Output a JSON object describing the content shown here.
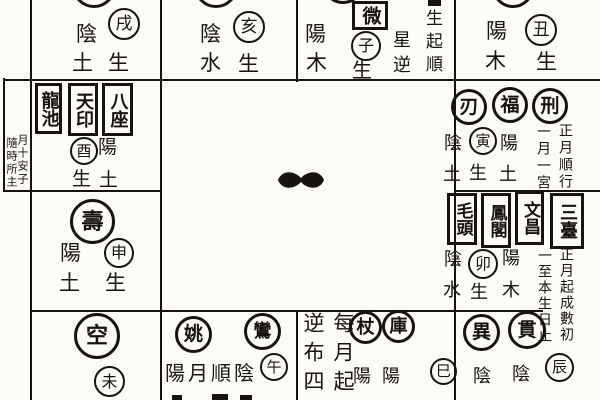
{
  "chart": {
    "ink_color": "#17130e",
    "paper_color": "#fcfbf7",
    "center_mark": "ink-blob",
    "palaces": {
      "xu": {
        "branch": "戌",
        "polarity": "陰",
        "element": "土",
        "sheng": "生"
      },
      "hai": {
        "branch": "亥",
        "polarity": "陰",
        "element": "水",
        "sheng": "生"
      },
      "zi": {
        "branch": "子",
        "polarity": "陽",
        "element": "木",
        "sheng": "生",
        "boxed_star": "微",
        "inner_note": "星逆",
        "rule_note": "生起順"
      },
      "chou": {
        "branch": "丑",
        "polarity": "陽",
        "element": "木",
        "sheng": "生"
      },
      "you": {
        "branch": "酉",
        "polarity": "陽",
        "element": "土",
        "sheng": "生",
        "boxed_stars": [
          "龍池",
          "天印",
          "八座"
        ],
        "margin_note_outer": "隨時所主",
        "margin_note_inner": "月十安子"
      },
      "yin": {
        "branch": "寅",
        "circle_stars": [
          "刃",
          "福",
          "刑"
        ],
        "polarity_left": "陰",
        "element_left": "土",
        "sheng": "生",
        "polarity_right": "陽",
        "element_right": "土",
        "rule_note_inner": "一月一宮",
        "rule_note_outer": "正月順行"
      },
      "shen": {
        "branch": "申",
        "big_star": "壽",
        "polarity": "陽",
        "element": "土",
        "sheng": "生"
      },
      "mao": {
        "branch": "卯",
        "boxed_stars": [
          "毛頭",
          "鳳閣",
          "文昌",
          "三臺"
        ],
        "polarity_left": "陰",
        "element_left": "水",
        "sheng": "生",
        "polarity_right": "陽",
        "element_right": "木",
        "rule_note_inner": "一至本生日止",
        "rule_note_outer": "正月起成數初"
      },
      "wei": {
        "branch": "未",
        "big_star": "空"
      },
      "wu": {
        "branch": "午",
        "circle_stars": [
          "姚",
          "鸞"
        ],
        "note": "陽月順陰"
      },
      "si": {
        "branch": "巳",
        "circle_stars": [
          "杖",
          "庫"
        ],
        "polarity_1": "陽",
        "polarity_2": "陽",
        "rule_note_left": "逆布四",
        "rule_note_right": "每月起"
      },
      "chen": {
        "branch": "辰",
        "circle_stars": [
          "異",
          "貫"
        ],
        "polarity_1": "陰",
        "polarity_2": "陰"
      }
    }
  }
}
